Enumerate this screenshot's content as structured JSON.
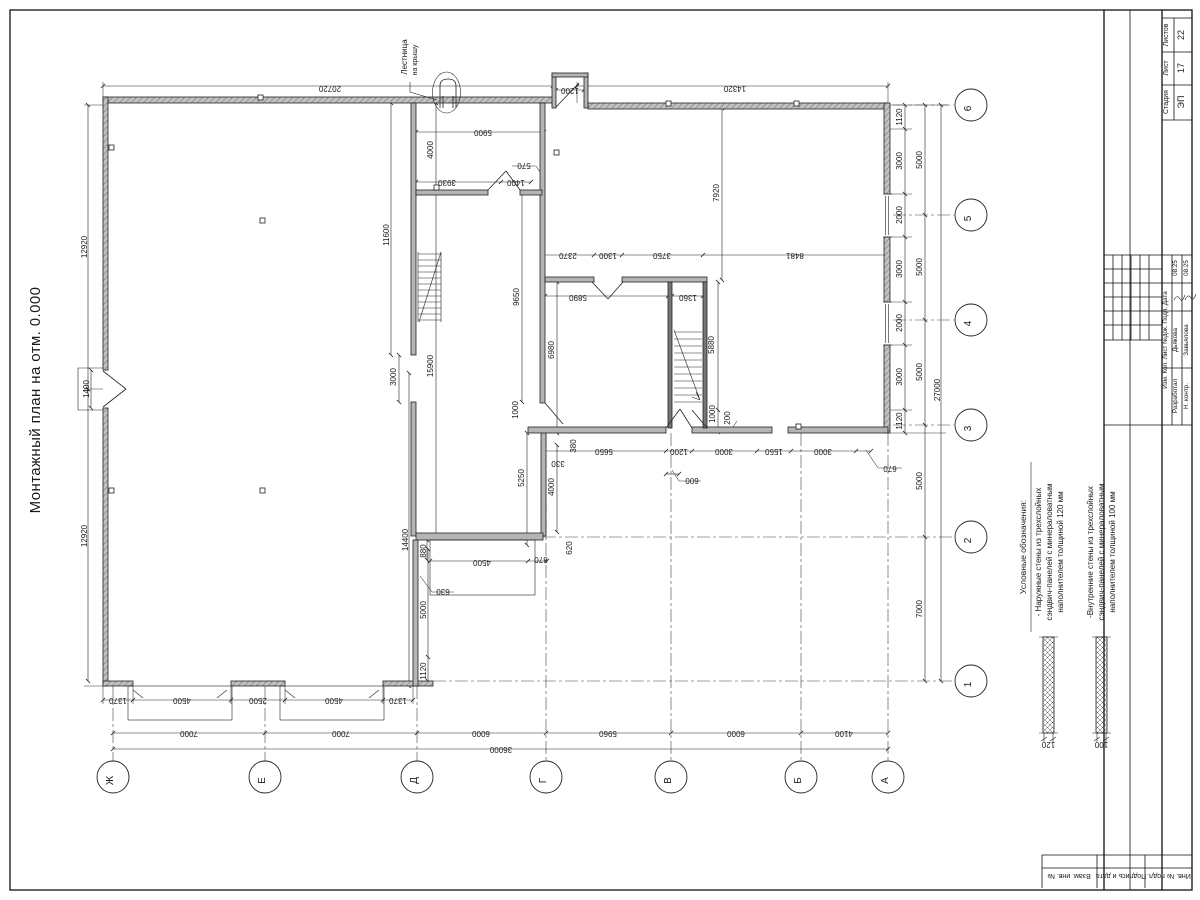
{
  "title": "Монтажный план на отм. 0.000",
  "roof_ladder": {
    "line1": "Лестница",
    "line2": "на крышу"
  },
  "legend": {
    "heading": "Условные обозначения:",
    "items": [
      {
        "lines": [
          "- Наружные стены из трехслойных",
          "сэндвич-панелей с минераловатным",
          "наполнителем толщиной 120 мм"
        ],
        "thickness": "120"
      },
      {
        "lines": [
          "-Внутренние стены из трехслойных",
          "сэндвич-панелей с минераловатным",
          "наполнителем толщиной 100 мм"
        ],
        "thickness": "100"
      }
    ]
  },
  "axes": {
    "bottom": [
      {
        "label": "Ж",
        "x": 113
      },
      {
        "label": "Е",
        "x": 265
      },
      {
        "label": "Д",
        "x": 417
      },
      {
        "label": "Г",
        "x": 546
      },
      {
        "label": "В",
        "x": 671
      },
      {
        "label": "Б",
        "x": 801
      },
      {
        "label": "А",
        "x": 888
      }
    ],
    "right": [
      {
        "label": "6",
        "y": 105
      },
      {
        "label": "5",
        "y": 215
      },
      {
        "label": "4",
        "y": 320
      },
      {
        "label": "3",
        "y": 425
      },
      {
        "label": "2",
        "y": 537
      },
      {
        "label": "1",
        "y": 681
      }
    ]
  },
  "plan": {
    "dimensions": [
      {
        "t": "20720",
        "x": 330,
        "y": 86,
        "r": 180
      },
      {
        "t": "14320",
        "x": 735,
        "y": 86,
        "r": 180
      },
      {
        "t": "1200",
        "x": 570,
        "y": 88,
        "r": 180
      },
      {
        "t": "5900",
        "x": 483,
        "y": 130,
        "r": 180
      },
      {
        "t": "3930",
        "x": 447,
        "y": 180,
        "r": 180
      },
      {
        "t": "1400",
        "x": 516,
        "y": 180,
        "r": 180
      },
      {
        "t": "570",
        "x": 524,
        "y": 163,
        "r": 180
      },
      {
        "t": "4000",
        "x": 433,
        "y": 150,
        "r": -90
      },
      {
        "t": "11600",
        "x": 389,
        "y": 235,
        "r": -90
      },
      {
        "t": "12920",
        "x": 87,
        "y": 247,
        "r": -90
      },
      {
        "t": "12920",
        "x": 87,
        "y": 536,
        "r": -90
      },
      {
        "t": "1400",
        "x": 89,
        "y": 389,
        "r": -90
      },
      {
        "t": "2370",
        "x": 568,
        "y": 253,
        "r": 180
      },
      {
        "t": "1300",
        "x": 608,
        "y": 253,
        "r": 180
      },
      {
        "t": "3750",
        "x": 662,
        "y": 253,
        "r": 180
      },
      {
        "t": "8481",
        "x": 795,
        "y": 253,
        "r": 180
      },
      {
        "t": "5890",
        "x": 578,
        "y": 295,
        "r": 180
      },
      {
        "t": "1360",
        "x": 688,
        "y": 295,
        "r": 180
      },
      {
        "t": "9650",
        "x": 519,
        "y": 297,
        "r": -90
      },
      {
        "t": "7920",
        "x": 719,
        "y": 193,
        "r": -90
      },
      {
        "t": "5880",
        "x": 714,
        "y": 345,
        "r": -90
      },
      {
        "t": "15900",
        "x": 433,
        "y": 366,
        "r": -90
      },
      {
        "t": "6980",
        "x": 554,
        "y": 350,
        "r": -90
      },
      {
        "t": "3000",
        "x": 396,
        "y": 377,
        "r": -90
      },
      {
        "t": "1000",
        "x": 518,
        "y": 410,
        "r": -90
      },
      {
        "t": "1000",
        "x": 715,
        "y": 414,
        "r": -90
      },
      {
        "t": "200",
        "x": 730,
        "y": 418,
        "r": -90
      },
      {
        "t": "380",
        "x": 576,
        "y": 446,
        "r": -90
      },
      {
        "t": "330",
        "x": 558,
        "y": 461,
        "r": 180
      },
      {
        "t": "5650",
        "x": 604,
        "y": 449,
        "r": 180
      },
      {
        "t": "1200",
        "x": 679,
        "y": 449,
        "r": 180
      },
      {
        "t": "3000",
        "x": 724,
        "y": 449,
        "r": 180
      },
      {
        "t": "1550",
        "x": 774,
        "y": 449,
        "r": 180
      },
      {
        "t": "3000",
        "x": 823,
        "y": 449,
        "r": 180
      },
      {
        "t": "670",
        "x": 890,
        "y": 466,
        "r": 180
      },
      {
        "t": "600",
        "x": 692,
        "y": 478,
        "r": 180
      },
      {
        "t": "5250",
        "x": 524,
        "y": 478,
        "r": -90
      },
      {
        "t": "4000",
        "x": 554,
        "y": 487,
        "r": -90
      },
      {
        "t": "620",
        "x": 572,
        "y": 548,
        "r": -90
      },
      {
        "t": "880",
        "x": 426,
        "y": 551,
        "r": -90
      },
      {
        "t": "4500",
        "x": 482,
        "y": 560,
        "r": 180
      },
      {
        "t": "870",
        "x": 541,
        "y": 557,
        "r": 180
      },
      {
        "t": "630",
        "x": 443,
        "y": 589,
        "r": 180
      },
      {
        "t": "14400",
        "x": 408,
        "y": 540,
        "r": -90
      },
      {
        "t": "5000",
        "x": 426,
        "y": 610,
        "r": -90
      },
      {
        "t": "1120",
        "x": 426,
        "y": 671,
        "r": -90
      },
      {
        "t": "1370",
        "x": 118,
        "y": 698,
        "r": 180
      },
      {
        "t": "4500",
        "x": 182,
        "y": 698,
        "r": 180
      },
      {
        "t": "2500",
        "x": 258,
        "y": 698,
        "r": 180
      },
      {
        "t": "4500",
        "x": 334,
        "y": 698,
        "r": 180
      },
      {
        "t": "1370",
        "x": 398,
        "y": 698,
        "r": 180
      },
      {
        "t": "7000",
        "x": 189,
        "y": 731,
        "r": 180
      },
      {
        "t": "7000",
        "x": 341,
        "y": 731,
        "r": 180
      },
      {
        "t": "6000",
        "x": 481,
        "y": 731,
        "r": 180
      },
      {
        "t": "5960",
        "x": 608,
        "y": 731,
        "r": 180
      },
      {
        "t": "6000",
        "x": 736,
        "y": 731,
        "r": 180
      },
      {
        "t": "4100",
        "x": 844,
        "y": 731,
        "r": 180
      },
      {
        "t": "36000",
        "x": 501,
        "y": 747,
        "r": 180
      },
      {
        "t": "1120",
        "x": 902,
        "y": 117,
        "r": -90
      },
      {
        "t": "3000",
        "x": 902,
        "y": 161,
        "r": -90
      },
      {
        "t": "2000",
        "x": 902,
        "y": 215,
        "r": -90
      },
      {
        "t": "3000",
        "x": 902,
        "y": 269,
        "r": -90
      },
      {
        "t": "2000",
        "x": 902,
        "y": 323,
        "r": -90
      },
      {
        "t": "3000",
        "x": 902,
        "y": 377,
        "r": -90
      },
      {
        "t": "1120",
        "x": 902,
        "y": 421,
        "r": -90
      },
      {
        "t": "5000",
        "x": 922,
        "y": 160,
        "r": -90
      },
      {
        "t": "5000",
        "x": 922,
        "y": 267,
        "r": -90
      },
      {
        "t": "5000",
        "x": 922,
        "y": 372,
        "r": -90
      },
      {
        "t": "5000",
        "x": 922,
        "y": 481,
        "r": -90
      },
      {
        "t": "7000",
        "x": 922,
        "y": 609,
        "r": -90
      },
      {
        "t": "27000",
        "x": 940,
        "y": 390,
        "r": -90
      }
    ]
  },
  "title_block": {
    "stage": {
      "label": "Стадия",
      "value": "ЭП"
    },
    "sheet": {
      "label": "Лист",
      "value": "17"
    },
    "sheets": {
      "label": "Листов",
      "value": "22"
    },
    "change_header": "Изм. Кол. Лист №док. Подп. Дата",
    "rows": [
      {
        "role": "Разработал",
        "name": "Дьякова",
        "date": "08.25"
      },
      {
        "role": "Н. контр.",
        "name": "Завьялова",
        "date": "08.25"
      }
    ],
    "side_labels": [
      "Взам. инв. №",
      "Подпись и дата",
      "Инв. № подл."
    ]
  }
}
